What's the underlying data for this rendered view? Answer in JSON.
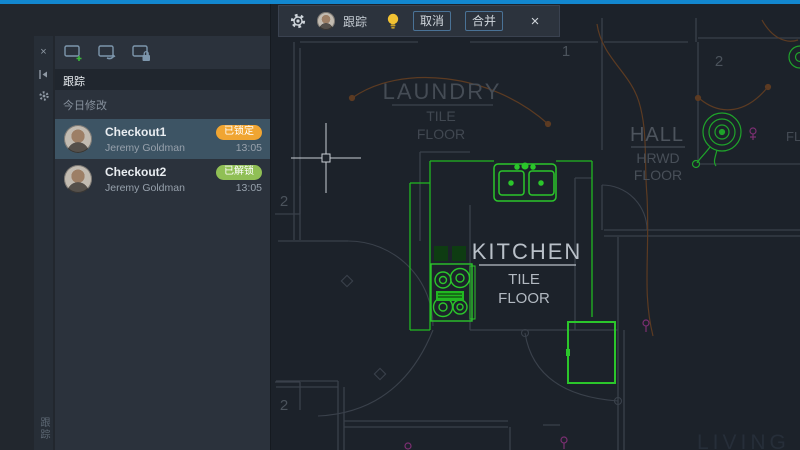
{
  "titlebar": {
    "accent_color": "#1287cf"
  },
  "toolbar": {
    "title": "跟踪",
    "cancel": "取消",
    "merge": "合并",
    "close": "×",
    "icons": [
      "settings-gear",
      "user-avatar",
      "hint-bulb"
    ]
  },
  "sidebar": {
    "strip": {
      "close": "×",
      "icons": [
        "close",
        "collapse-left",
        "settings-gear"
      ]
    },
    "toolbar_icons": [
      "new-checkout",
      "checkout-arrow",
      "checkout-lock"
    ],
    "header": "跟踪",
    "section": "今日修改",
    "tab_label": "跟踪",
    "items": [
      {
        "title": "Checkout1",
        "status": "已锁定",
        "status_color": "#f0a532",
        "user": "Jeremy Goldman",
        "time": "13:05",
        "selected": true
      },
      {
        "title": "Checkout2",
        "status": "已解锁",
        "status_color": "#90bf55",
        "user": "Jeremy Goldman",
        "time": "13:05",
        "selected": false
      }
    ]
  },
  "canvas": {
    "labels": {
      "laundry": {
        "name": "LAUNDRY",
        "l1": "TILE",
        "l2": "FLOOR"
      },
      "kitchen": {
        "name": "KITCHEN",
        "l1": "TILE",
        "l2": "FLOOR"
      },
      "hall": {
        "name": "HALL",
        "l1": "HRWD",
        "l2": "FLOOR"
      },
      "living": "LIVING R",
      "partial_right": "FL"
    },
    "markers": {
      "m1": "1",
      "m2": "2",
      "m3": "2",
      "m4": "2"
    },
    "colors": {
      "highlight_green": "#21b821",
      "wall_gray": "#3a414b",
      "wiring_orange": "#5c3b22",
      "outlet_magenta": "#7c2f72",
      "label_bright": "#b9c0c8",
      "label_dim": "#454c55",
      "background": "#1c222a"
    }
  }
}
